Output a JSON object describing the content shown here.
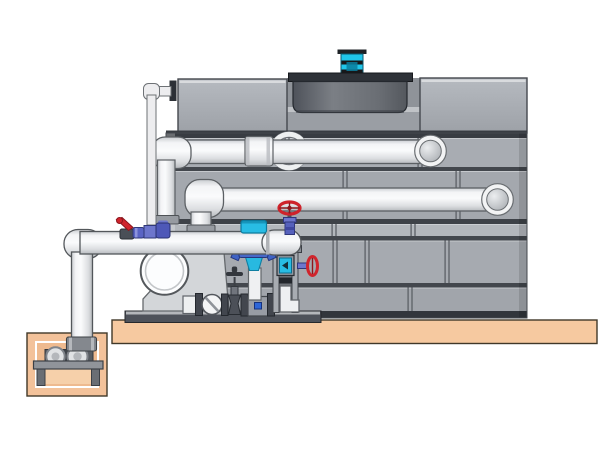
{
  "diagram": {
    "kind": "cooling-tower-pump-system-illustration",
    "background": "#ffffff",
    "palette": {
      "tank_panel": "#a5a9af",
      "tank_panel_light": "#b3b7bc",
      "tank_line_dark": "#383c42",
      "tank_edge_dark": "#888c92",
      "fan_shroud": "#5f6369",
      "fan_flange": "#2e3238",
      "motor_cyan": "#20c6ea",
      "motor_black": "#17181a",
      "pipe_light": "#f2f3f4",
      "pipe_shadow": "#c4c7ca",
      "pipe_outline": "#5c6064",
      "valve_red": "#d0242c",
      "valve_purple": "#5560bc",
      "fitting_blue": "#4668c8",
      "actuator_cyan": "#28bce4",
      "slab_tan": "#f6c9a0",
      "pit_tan": "#eeba8f",
      "metal_dark": "#4e525a",
      "metal_mid": "#989ca4",
      "white": "#fcfdfe"
    },
    "components": [
      "fan-motor",
      "fan-shroud",
      "tower-upper-left-panel",
      "tower-upper-right-panel",
      "tower-casing-panels",
      "wall-penetration-ring",
      "upper-supply-pipe",
      "lower-supply-pipe",
      "pipe-union",
      "overflow-pipe",
      "suction-header",
      "riser-drop-1",
      "riser-drop-2",
      "red-ball-valve",
      "solenoid-fitting-cluster",
      "butterfly-valve-actuator",
      "suction-diffuser-strainer",
      "gate-valve-red-handwheel",
      "side-gate-valve",
      "pump-volute",
      "wafer-check-valve",
      "gate-valve-tap-handle",
      "drain-tee",
      "control-column",
      "control-panel-screen",
      "skid-base",
      "concrete-slab",
      "sump-pit",
      "sump-pump",
      "pump-platform",
      "sump-riser-pipe"
    ]
  }
}
